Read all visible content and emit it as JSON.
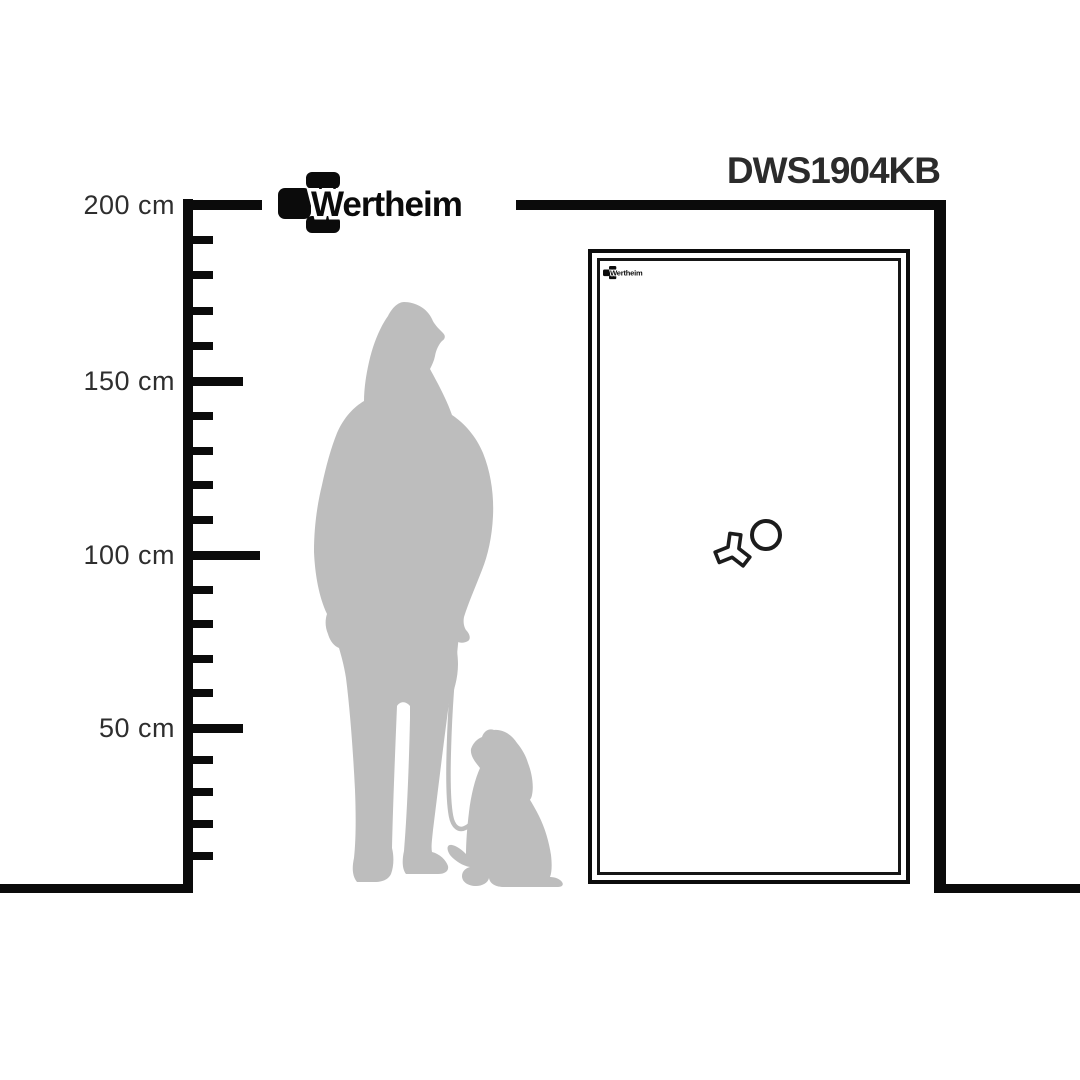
{
  "brand": {
    "name": "Wertheim",
    "logo_icon": "three-block-cross-mark",
    "logo_color": "#0b0b0b"
  },
  "header": {
    "model_code": "DWS1904KB",
    "text_color": "#2b2b2b"
  },
  "ruler": {
    "unit": "cm",
    "labels": [
      "200 cm",
      "150 cm",
      "100 cm",
      "50 cm"
    ],
    "major_values_cm": [
      200,
      150,
      100,
      50
    ],
    "minor_step_cm": 10,
    "line_color": "#0b0b0b"
  },
  "safe": {
    "logo_text": "Wertheim",
    "door_style": "double-frame outline",
    "knob_icon": "three-spoke-handle",
    "dial_icon": "round-dial",
    "outline_color": "#0c0c0c"
  },
  "figures": {
    "silhouette_icon": "woman-with-puppy-on-leash-silhouette",
    "silhouette_color": "#bdbdbd"
  }
}
